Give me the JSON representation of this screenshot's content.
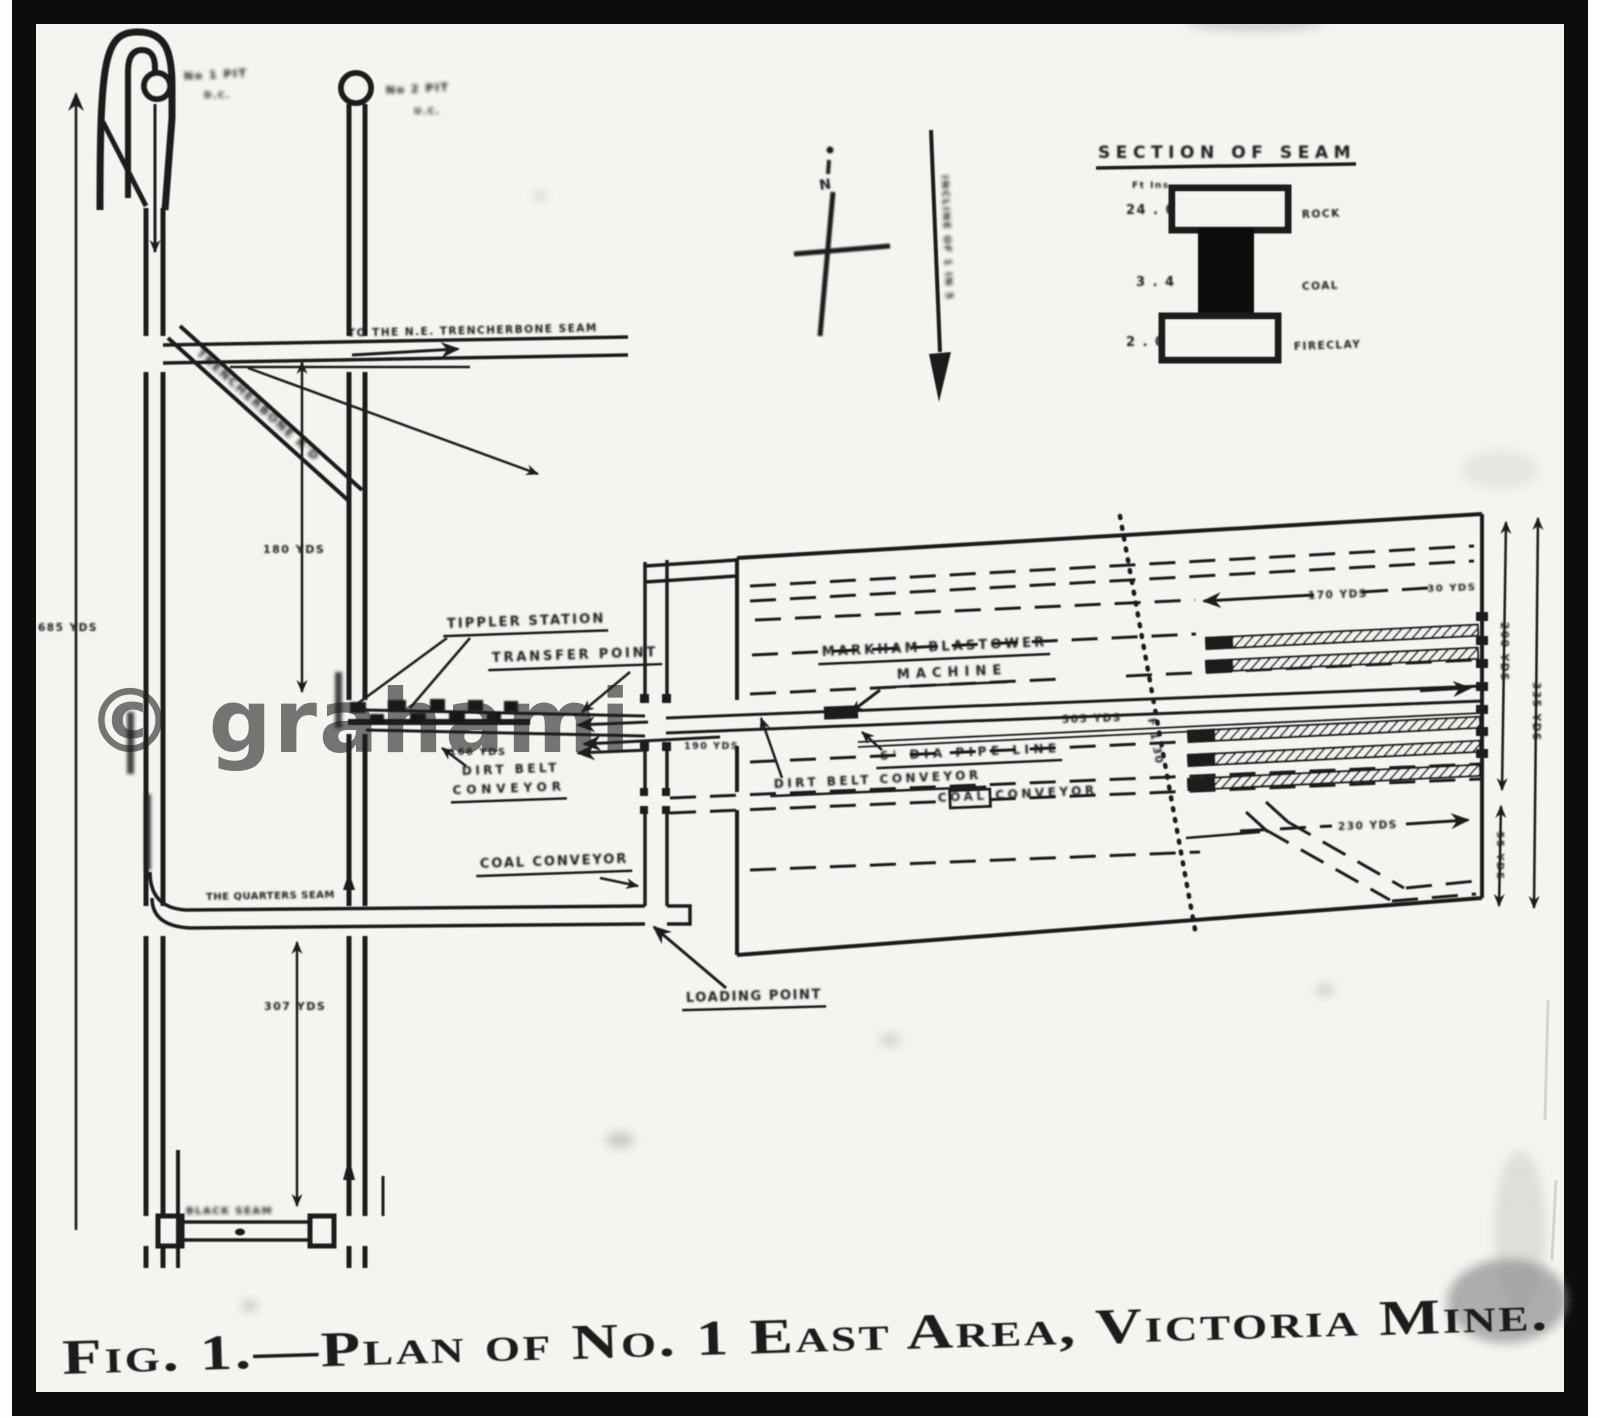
{
  "figure": {
    "caption": "Fig. 1.—Plan of No. 1 East Area, Victoria Mine.",
    "watermark": "© grahami"
  },
  "compass": {
    "north_label": "N"
  },
  "incline_label": "INCLINE OF 1 IN 5",
  "seam_section": {
    "title": "SECTION OF SEAM",
    "units_label": "Ft  Ins",
    "layers": [
      {
        "thickness": "24 . 0",
        "name": "ROCK"
      },
      {
        "thickness": "3 . 4",
        "name": "COAL"
      },
      {
        "thickness": "2 . 0",
        "name": "FIRECLAY"
      }
    ]
  },
  "pits": {
    "pit1_line1": "No 1 PIT",
    "pit1_line2": "D.C.",
    "pit2_line1": "No 2 PIT",
    "pit2_line2": "U.C."
  },
  "roads": {
    "trencherbone_main": "TO THE N.E. TRENCHERBONE SEAM",
    "trencherbone_branch": "TRENCHERBONE R'D",
    "quarters_seam": "THE QUARTERS SEAM",
    "black_seam": "BLACK SEAM"
  },
  "equipment": {
    "tippler_station": "TIPPLER STATION",
    "transfer_point": "TRANSFER POINT",
    "dirt_belt_left_line1": "DIRT BELT",
    "dirt_belt_left_line2": "CONVEYOR",
    "dirt_belt_right": "DIRT BELT CONVEYOR",
    "markham_line1": "MARKHAM BLASTOWER",
    "markham_line2": "MACHINE",
    "pipe_line": "6' DIA PIPE LINE",
    "coal_conveyor_panel": "COAL CONVEYOR",
    "coal_conveyor_left": "COAL CONVEYOR",
    "loading_point": "LOADING POINT"
  },
  "distances": {
    "shaft_depth": "685 YDS",
    "pit_spacing": "180 YDS",
    "quarters_depth": "307 YDS",
    "tippler_length": "166 YDS",
    "transfer_length": "190 YDS",
    "main_road": "505 YDS",
    "face_advance": "170 YDS",
    "face_right": "30 YDS",
    "bottom_road": "230 YDS",
    "panel_width_top": "200 YDS",
    "panel_width_bottom": "55 YDS",
    "panel_width_total": "335 YDS"
  },
  "fault_label": "F 1 30"
}
